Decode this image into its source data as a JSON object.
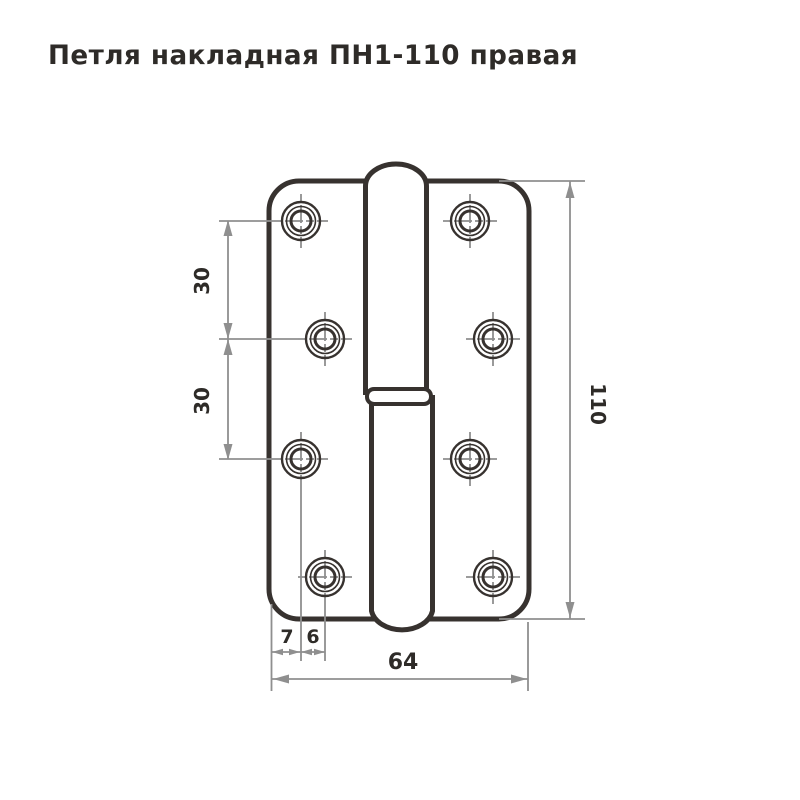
{
  "title": "Петля накладная ПН1-110 правая",
  "drawing": {
    "dimensions": {
      "hole_spacing_upper": "30",
      "hole_spacing_lower": "30",
      "overall_height": "110",
      "overall_width": "64",
      "edge_to_first_hole": "7",
      "hole_column_offset": "6"
    },
    "colors": {
      "outline": "#37322f",
      "dimension_lines": "#8f8f8f",
      "label_text": "#2e2b28",
      "background": "#ffffff"
    }
  }
}
